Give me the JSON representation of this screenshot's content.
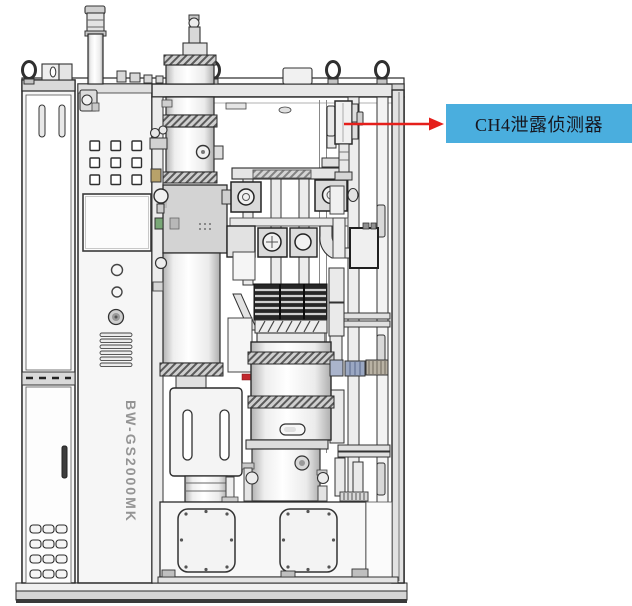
{
  "canvas": {
    "width": 632,
    "height": 606,
    "background": "#ffffff"
  },
  "figure": {
    "kind": "equipment-cad-diagram",
    "model_label": "BW-GS2000MK"
  },
  "callout": {
    "text": "CH4泄露侦测器",
    "bg_color": "#4aaede",
    "text_color": "#16161f",
    "arrow_color": "#e51f1b"
  }
}
